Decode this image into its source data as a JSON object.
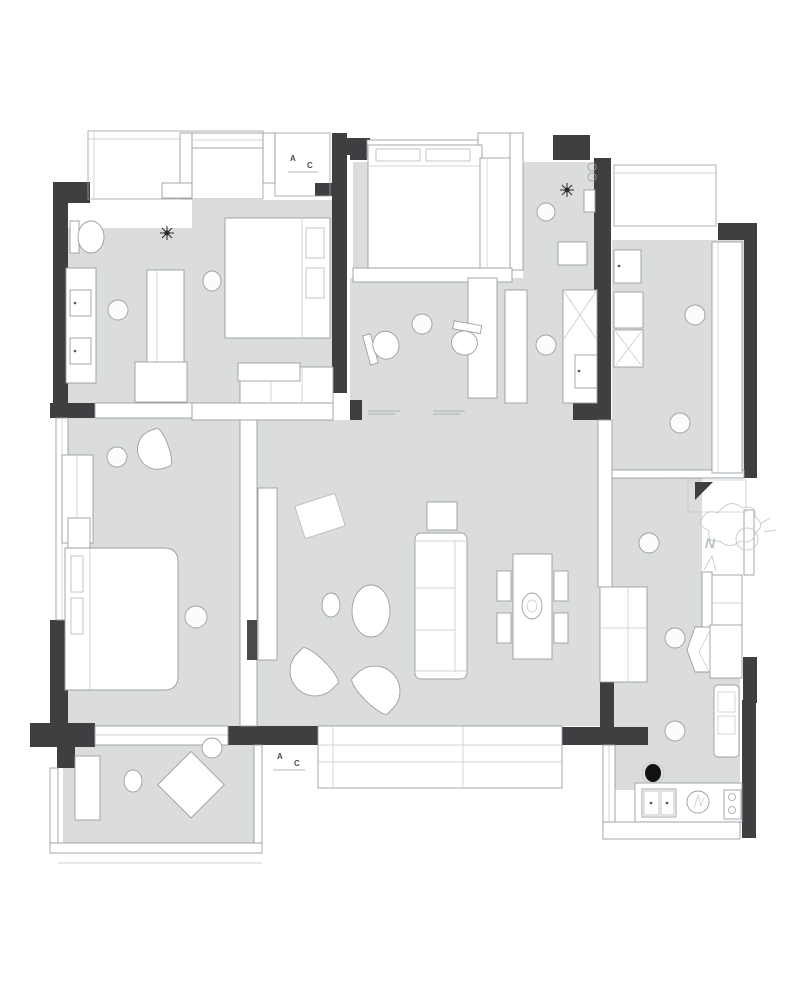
{
  "colors": {
    "wall": "#3f3f41",
    "floor": "#dbdcdc",
    "furniture_fill": "#ffffff",
    "furniture_line": "#9aa0a3",
    "sketch": "#c6cbce",
    "background": "#ffffff"
  },
  "labels": {
    "ac_platform_top": {
      "a": "A",
      "c": "C"
    },
    "ac_platform_bottom": {
      "a": "A",
      "c": "C"
    },
    "compass": {
      "north": "N"
    }
  }
}
